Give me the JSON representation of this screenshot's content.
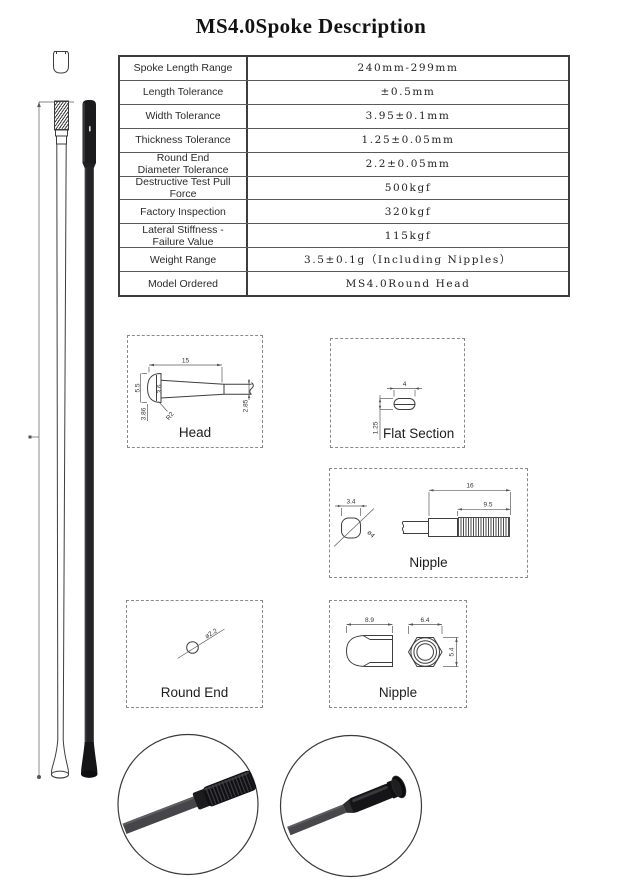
{
  "page": {
    "title": "MS4.0Spoke Description"
  },
  "spec_table": {
    "rows": [
      {
        "label": "Spoke Length Range",
        "value": "240mm-299mm"
      },
      {
        "label": "Length Tolerance",
        "value": "±0.5mm"
      },
      {
        "label": "Width Tolerance",
        "value": "3.95±0.1mm"
      },
      {
        "label": "Thickness Tolerance",
        "value": "1.25±0.05mm"
      },
      {
        "label": "Round End\nDiameter Tolerance",
        "value": "2.2±0.05mm"
      },
      {
        "label": "Destructive Test Pull Force",
        "value": "500kgf"
      },
      {
        "label": "Factory Inspection",
        "value": "320kgf"
      },
      {
        "label": "Lateral Stiffness -\nFailure Value",
        "value": "115kgf"
      },
      {
        "label": "Weight Range",
        "value": "3.5±0.1g（Including Nipples）"
      },
      {
        "label": "Model Ordered",
        "value": "MS4.0Round Head"
      }
    ]
  },
  "diagrams": {
    "head": {
      "label": "Head",
      "dim_length": "15",
      "dim_height": "5.5",
      "dim_neck": "3.6",
      "dim_head": "3.86",
      "dim_radius": "R2",
      "dim_shaft": "2.85"
    },
    "flat_section": {
      "label": "Flat Section",
      "dim_width": "4",
      "dim_thickness": "1.25"
    },
    "nipple_side": {
      "label": "Nipple",
      "dim_flat": "3.4",
      "dim_diameter": "ø4",
      "dim_total_length": "16",
      "dim_thread_length": "9.5"
    },
    "round_end": {
      "label": "Round End",
      "dim_diameter": "ø2.2"
    },
    "nipple_front": {
      "label": "Nipple",
      "dim_length": "8.9",
      "dim_width": "6.4",
      "dim_height": "5.4"
    }
  },
  "colors": {
    "ink": "#1d1d1d",
    "line": "#3e3e3e",
    "dash_border": "#8a8a8a",
    "spoke_black": "#1b1b1d"
  }
}
